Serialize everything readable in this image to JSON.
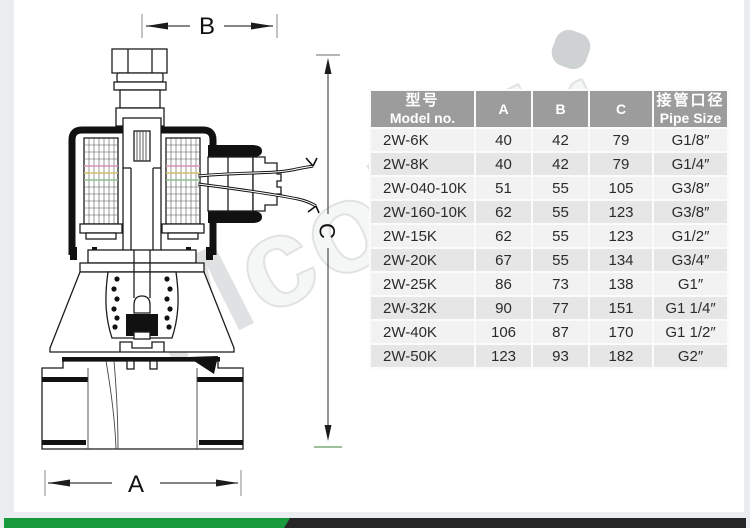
{
  "diagram": {
    "dim_a_label": "A",
    "dim_b_label": "B",
    "dim_c_label": "C"
  },
  "watermark": {
    "letter_main": "M",
    "letters_rest": "coLair"
  },
  "table": {
    "headers": {
      "model_zh": "型号",
      "model_en": "Model no.",
      "a": "A",
      "b": "B",
      "c": "C",
      "pipe_zh": "接管口径",
      "pipe_en": "Pipe Size"
    },
    "rows": [
      {
        "model": "2W-6K",
        "a": "40",
        "b": "42",
        "c": "79",
        "pipe": "G1/8″"
      },
      {
        "model": "2W-8K",
        "a": "40",
        "b": "42",
        "c": "79",
        "pipe": "G1/4″"
      },
      {
        "model": "2W-040-10K",
        "a": "51",
        "b": "55",
        "c": "105",
        "pipe": "G3/8″"
      },
      {
        "model": "2W-160-10K",
        "a": "62",
        "b": "55",
        "c": "123",
        "pipe": "G3/8″"
      },
      {
        "model": "2W-15K",
        "a": "62",
        "b": "55",
        "c": "123",
        "pipe": "G1/2″"
      },
      {
        "model": "2W-20K",
        "a": "67",
        "b": "55",
        "c": "134",
        "pipe": "G3/4″"
      },
      {
        "model": "2W-25K",
        "a": "86",
        "b": "73",
        "c": "138",
        "pipe": "G1″"
      },
      {
        "model": "2W-32K",
        "a": "90",
        "b": "77",
        "c": "151",
        "pipe": "G1 1/4″"
      },
      {
        "model": "2W-40K",
        "a": "106",
        "b": "87",
        "c": "170",
        "pipe": "G1 1/2″"
      },
      {
        "model": "2W-50K",
        "a": "123",
        "b": "93",
        "c": "182",
        "pipe": "G2″"
      }
    ]
  },
  "colors": {
    "accent_green": "#189a3c",
    "bar_dark": "#262626",
    "table_header_gray": "#9c9c9c",
    "page_edge_gray": "#ebeef0",
    "tick_green": "#9cbf9c"
  }
}
